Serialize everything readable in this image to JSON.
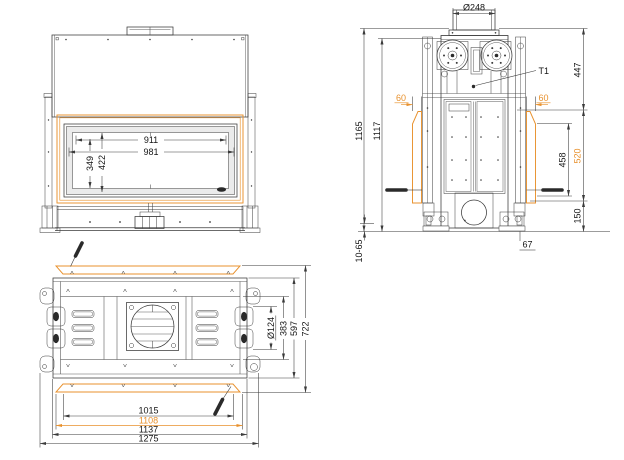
{
  "meta": {
    "drawing_type": "fireplace insert dimensional drawing, three orthographic views",
    "accent_color": "#E8912D",
    "line_color": "#3a3a3a"
  },
  "front_view": {
    "glass_inner_width": "911",
    "glass_outer_width": "981",
    "door_height": "422",
    "glass_inner_height": "349"
  },
  "side_view": {
    "flue_diameter": "Ø248",
    "sensor_label": "T1",
    "upper_section_height": "447",
    "left_glass_offset": "60",
    "right_glass_offset": "60",
    "overall_height": "1165",
    "body_height": "1117",
    "glass_inner_height": "458",
    "glass_height": "520",
    "base_section_height": "150",
    "leveling_range": "10-65",
    "rear_offset": "67"
  },
  "top_view": {
    "opening_width": "1015",
    "glass_width": "1108",
    "body_width": "1137",
    "overall_width": "1275",
    "circle_diameter": "Ø124",
    "inner_depth": "383",
    "body_depth": "597",
    "overall_depth": "722"
  }
}
